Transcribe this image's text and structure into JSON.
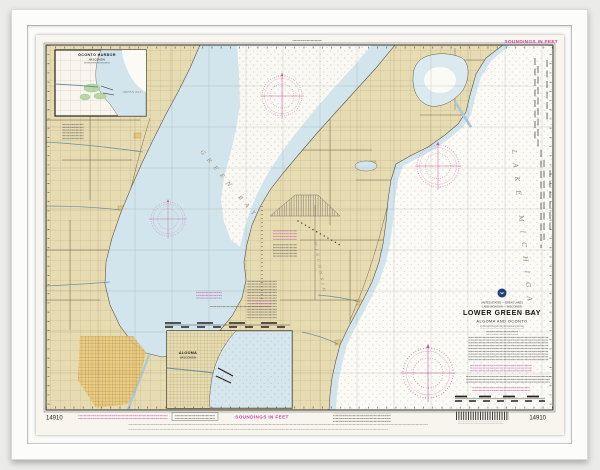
{
  "artwork": {
    "chart_number": "14910",
    "soundings_note": "SOUNDINGS IN FEET",
    "title_block": {
      "nation_line": "UNITED STATES — GREAT LAKES",
      "region_line": "LAKE MICHIGAN — WISCONSIN",
      "title": "LOWER GREEN BAY",
      "subtitle": "ALGOMA AND OCONTO"
    },
    "water_labels": {
      "lake": "LAKE MICHIGAN",
      "bay": "GREEN BAY",
      "state": "WISCONSIN"
    },
    "insets": {
      "oconto": {
        "line1": "OCONTO HARBOR",
        "line2": "WISCONSIN",
        "water": "GREEN BAY"
      },
      "algoma": {
        "line1": "ALGOMA",
        "line2": "WISCONSIN"
      }
    },
    "colors": {
      "land": "#e7dbb1",
      "shallow_water": "#d2e5ec",
      "deep_water": "#fbfaf5",
      "magenta": "#c0569f",
      "marsh": "#b7d6a2",
      "city": "#e9c777"
    }
  }
}
